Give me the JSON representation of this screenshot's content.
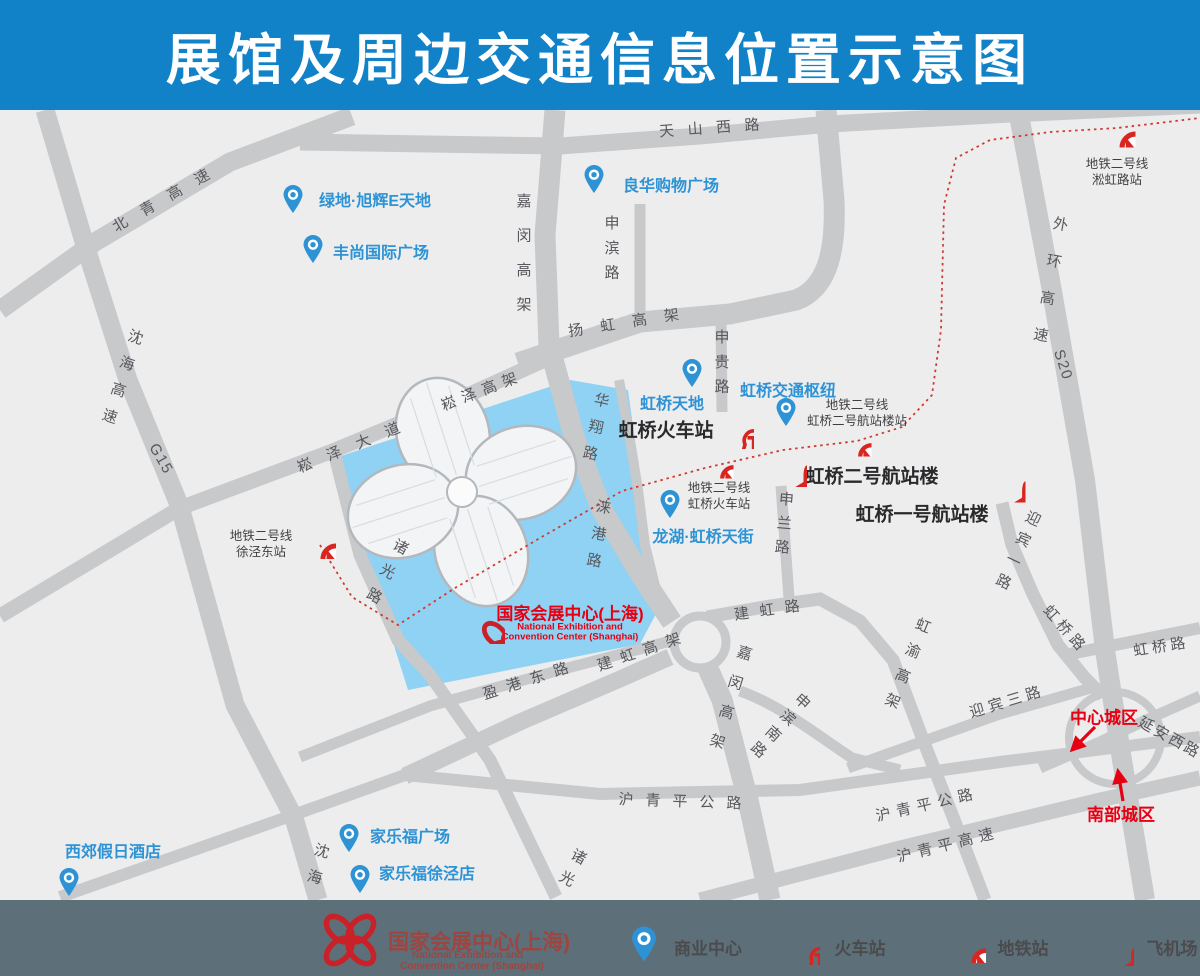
{
  "title": "展馆及周边交通信息位置示意图",
  "colors": {
    "title_bar": "#1182c8",
    "map_bg": "#ededee",
    "road": "#c7c9cb",
    "water": "#8fd2f3",
    "icon_red": "#d8251f",
    "poi_blue": "#2e93d4",
    "black_label": "#2a2a2c",
    "road_label": "#58585c",
    "accent_red": "#e60012",
    "legend_bg": "#5d6f79",
    "legend_text": "#4b4b4d",
    "legend_title": "#9e4540"
  },
  "map": {
    "road_labels": [
      {
        "id": "beiqing-expressway",
        "text": "北青高速",
        "x": 168,
        "y": 196,
        "rot": -30,
        "ls": 1.1
      },
      {
        "id": "tianshan-west-road",
        "text": "天山西路",
        "x": 716,
        "y": 127,
        "rot": -4,
        "ls": 0.9
      },
      {
        "id": "jiamin-elevated-north",
        "text": "嘉闵高架",
        "x": 523,
        "y": 262,
        "rot": 0,
        "ls": 1.3,
        "v": true
      },
      {
        "id": "shenbin-road",
        "text": "申滨路",
        "x": 611,
        "y": 252,
        "rot": 0,
        "ls": 0.65,
        "v": true
      },
      {
        "id": "shenhai-expressway",
        "text": "沈海高速",
        "x": 120,
        "y": 382,
        "rot": 18,
        "ls": 0.85,
        "v": true
      },
      {
        "id": "g15",
        "text": "G15",
        "x": 161,
        "y": 459,
        "rot": 60,
        "ls": 0.1
      },
      {
        "id": "songze-elevated",
        "text": "崧泽高架",
        "x": 482,
        "y": 390,
        "rot": -21,
        "ls": 0.45
      },
      {
        "id": "songze-avenue",
        "text": "崧泽大道",
        "x": 356,
        "y": 444,
        "rot": -22,
        "ls": 1.1
      },
      {
        "id": "yanghong-elevated",
        "text": "扬虹高架",
        "x": 632,
        "y": 321,
        "rot": -9,
        "ls": 1.15
      },
      {
        "id": "shengui-road",
        "text": "申贵路",
        "x": 721,
        "y": 366,
        "rot": 0,
        "ls": 0.65,
        "v": true
      },
      {
        "id": "waihuan-expressway",
        "text": "外环高速",
        "x": 1048,
        "y": 290,
        "rot": 10,
        "ls": 1.5,
        "v": true
      },
      {
        "id": "s20",
        "text": "S20",
        "x": 1063,
        "y": 365,
        "rot": 72,
        "ls": 0.1
      },
      {
        "id": "huaxiang-road",
        "text": "华翔路",
        "x": 594,
        "y": 432,
        "rot": 12,
        "ls": 0.8,
        "v": true
      },
      {
        "id": "laigang-road",
        "text": "涞港路",
        "x": 597,
        "y": 539,
        "rot": 10,
        "ls": 0.8,
        "v": true
      },
      {
        "id": "zhuguang-road-upper",
        "text": "诸光路",
        "x": 384,
        "y": 576,
        "rot": 28,
        "ls": 0.85,
        "v": true
      },
      {
        "id": "zhuguang-road-lower",
        "text": "诸光",
        "x": 570,
        "y": 871,
        "rot": 28,
        "ls": 0.65,
        "v": true
      },
      {
        "id": "shenhai-lower",
        "text": "沈海",
        "x": 316,
        "y": 869,
        "rot": 15,
        "ls": 0.8,
        "v": true
      },
      {
        "id": "jiamin-elevated-south",
        "text": "嘉闵高架",
        "x": 728,
        "y": 704,
        "rot": 17,
        "ls": 1.05,
        "v": true
      },
      {
        "id": "shenbin-south-road",
        "text": "申滨南路",
        "x": 778,
        "y": 727,
        "rot": 42,
        "ls": 0.45,
        "v": true
      },
      {
        "id": "shenlan-road",
        "text": "申兰路",
        "x": 783,
        "y": 527,
        "rot": 5,
        "ls": 0.6,
        "v": true
      },
      {
        "id": "jianhong-road",
        "text": "建虹路",
        "x": 772,
        "y": 609,
        "rot": -8,
        "ls": 0.7
      },
      {
        "id": "jianhong-elevated",
        "text": "建虹高架",
        "x": 643,
        "y": 650,
        "rot": -19,
        "ls": 0.6
      },
      {
        "id": "yinggang-east-road",
        "text": "盈港东路",
        "x": 530,
        "y": 679,
        "rot": -18,
        "ls": 0.65
      },
      {
        "id": "hongyu-elevated",
        "text": "虹渝高架",
        "x": 905,
        "y": 668,
        "rot": 22,
        "ls": 0.8,
        "v": true
      },
      {
        "id": "yingbin-1st-road",
        "text": "迎宾一路",
        "x": 1016,
        "y": 553,
        "rot": 25,
        "ls": 0.55,
        "v": true
      },
      {
        "id": "yingbin-3rd-road",
        "text": "迎宾三路",
        "x": 1007,
        "y": 701,
        "rot": -17,
        "ls": 0.3
      },
      {
        "id": "hongqiao-road-sw",
        "text": "虹桥路",
        "x": 1066,
        "y": 629,
        "rot": 48,
        "ls": 0.3
      },
      {
        "id": "hongqiao-road-east",
        "text": "虹桥路",
        "x": 1161,
        "y": 646,
        "rot": -9,
        "ls": 0.25
      },
      {
        "id": "yanan-west-road",
        "text": "延安西路",
        "x": 1170,
        "y": 737,
        "rot": 29,
        "ls": 0.15
      },
      {
        "id": "huqingping-highway-center",
        "text": "沪青平公路",
        "x": 686,
        "y": 801,
        "rot": 2,
        "ls": 0.8
      },
      {
        "id": "huqingping-highway-right",
        "text": "沪青平公路",
        "x": 927,
        "y": 804,
        "rot": -13,
        "ls": 0.4
      },
      {
        "id": "huqingping-expressway",
        "text": "沪青平高速",
        "x": 948,
        "y": 844,
        "rot": -14,
        "ls": 0.4
      }
    ],
    "pois": [
      {
        "id": "greenland-xuhui-e-world",
        "text": "绿地·旭辉E天地",
        "tx": 375,
        "ty": 199,
        "px": 293,
        "py": 214
      },
      {
        "id": "fengshang-intl-plaza",
        "text": "丰尚国际广场",
        "tx": 381,
        "ty": 251,
        "px": 313,
        "py": 264
      },
      {
        "id": "lianghua-shopping-plaza",
        "text": "良华购物广场",
        "tx": 671,
        "ty": 184,
        "px": 594,
        "py": 194
      },
      {
        "id": "hongqiao-tiandi",
        "text": "虹桥天地",
        "tx": 672,
        "ty": 402,
        "px": 692,
        "py": 388
      },
      {
        "id": "hongqiao-transport-hub",
        "text": "虹桥交通枢纽",
        "tx": 788,
        "ty": 389,
        "px": 786,
        "py": 427
      },
      {
        "id": "longfor-paradise-walk",
        "text": "龙湖·虹桥天街",
        "tx": 703,
        "ty": 535,
        "px": 670,
        "py": 519
      },
      {
        "id": "xijiao-holiday-hotel",
        "text": "西郊假日酒店",
        "tx": 113,
        "ty": 850,
        "px": 69,
        "py": 897
      },
      {
        "id": "carrefour-plaza",
        "text": "家乐福广场",
        "tx": 410,
        "ty": 835,
        "px": 349,
        "py": 853
      },
      {
        "id": "carrefour-xujing",
        "text": "家乐福徐泾店",
        "tx": 427,
        "ty": 872,
        "px": 360,
        "py": 894
      }
    ],
    "landmarks": [
      {
        "id": "hongqiao-railway-station",
        "text": "虹桥火车站",
        "tx": 666,
        "ty": 429,
        "icon": "train",
        "ix": 734,
        "iy": 429,
        "is": 40
      },
      {
        "id": "terminal-2",
        "text": "虹桥二号航站楼",
        "tx": 872,
        "ty": 475,
        "icon": "plane",
        "ix": 783,
        "iy": 463,
        "is": 48
      },
      {
        "id": "terminal-1",
        "text": "虹桥一号航站楼",
        "tx": 922,
        "ty": 513,
        "icon": "plane",
        "ix": 1002,
        "iy": 479,
        "is": 47
      }
    ],
    "metro_stations": [
      {
        "id": "xujingdong-station",
        "lines": [
          "地铁二号线",
          "徐泾东站"
        ],
        "ix": 318,
        "iy": 541,
        "is": 36,
        "lx": 261,
        "ly": 544
      },
      {
        "id": "hongqiao-railway-metro",
        "lines": [
          "地铁二号线",
          "虹桥火车站"
        ],
        "ix": 718,
        "iy": 463,
        "is": 31,
        "lx": 719,
        "ly": 496
      },
      {
        "id": "terminal2-metro-station",
        "lines": [
          "地铁二号线",
          "虹桥二号航站楼站"
        ],
        "ix": 856,
        "iy": 441,
        "is": 31,
        "lx": 857,
        "ly": 413
      },
      {
        "id": "songhong-road-station",
        "lines": [
          "地铁二号线",
          "淞虹路站"
        ],
        "ix": 1117,
        "iy": 129,
        "is": 37,
        "lx": 1117,
        "ly": 172
      }
    ],
    "necc": {
      "title": "国家会展中心(上海)",
      "latin1": "National Exhibition and",
      "latin2": "Convention Center (Shanghai)",
      "logo_x": 477,
      "logo_y": 616,
      "tx": 570,
      "ty": 612
    },
    "districts": [
      {
        "id": "central-district",
        "text": "中心城区",
        "x": 1104,
        "y": 716
      },
      {
        "id": "southern-district",
        "text": "南部城区",
        "x": 1121,
        "y": 813
      }
    ]
  },
  "legend": {
    "necc": {
      "title": "国家会展中心(上海)",
      "latin1": "National Exhibition and",
      "latin2": "Convention Center (Shanghai)"
    },
    "items": [
      {
        "id": "commercial-center",
        "icon": "pin",
        "text": "商业中心",
        "ix": 644,
        "iy": 944,
        "is": 30,
        "lx": 708,
        "ly": 947
      },
      {
        "id": "railway-station",
        "icon": "train",
        "text": "火车站",
        "ix": 802,
        "iy": 947,
        "is": 36,
        "lx": 860,
        "ly": 947
      },
      {
        "id": "metro-station",
        "icon": "metro",
        "text": "地铁站",
        "ix": 969,
        "iy": 946,
        "is": 34,
        "lx": 1023,
        "ly": 947
      },
      {
        "id": "airport",
        "icon": "plane",
        "text": "飞机场",
        "ix": 1114,
        "iy": 946,
        "is": 40,
        "lx": 1172,
        "ly": 947
      }
    ]
  }
}
